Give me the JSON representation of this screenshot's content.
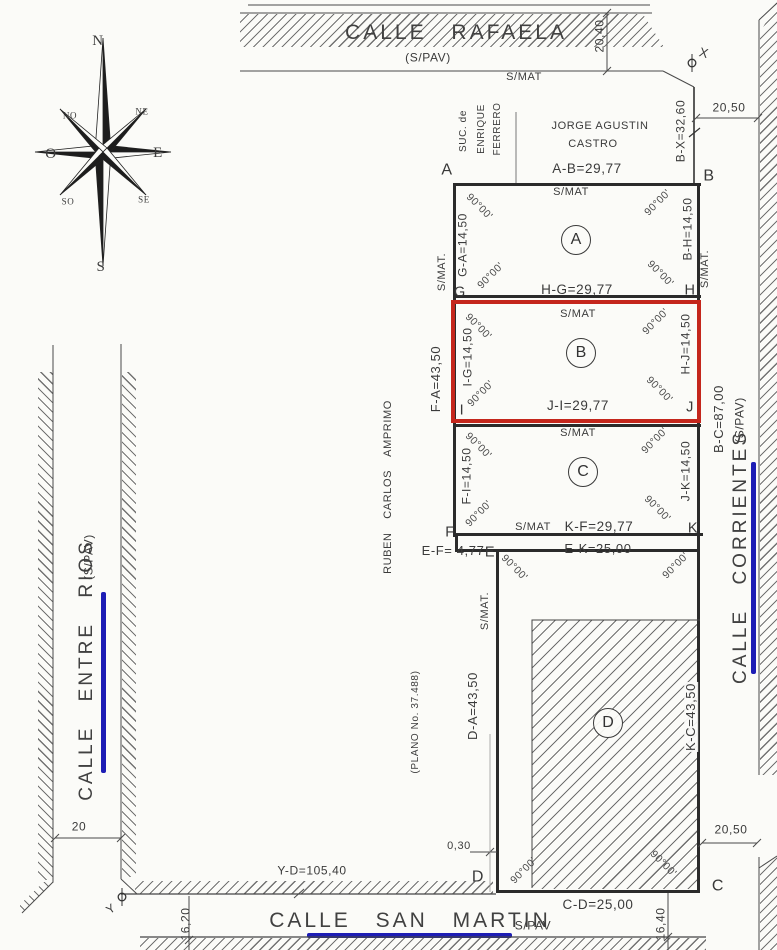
{
  "compass": {
    "n": "N",
    "s": "S",
    "e": "E",
    "o": "O",
    "ne": "NE",
    "no": "NO",
    "se": "SE",
    "so": "SO"
  },
  "streets": {
    "rafaela": {
      "name": "CALLE RAFAELA",
      "surface": "(S/PAV)"
    },
    "corrientes": {
      "name": "CALLE CORRIENTES",
      "surface": "(S/PAV)"
    },
    "entre_rios": {
      "name": "CALLE ENTRE RIOS",
      "surface": "(S/PAV)"
    },
    "san_martin": {
      "name": "CALLE SAN MARTIN",
      "surface": "S/PAV"
    }
  },
  "neighbors": {
    "ferrero_line1": "SUC. de",
    "ferrero_line2": "ENRIQUE",
    "ferrero_line3": "FERRERO",
    "castro_line1": "JORGE AGUSTIN",
    "castro_line2": "CASTRO",
    "amprimo": "RUBEN CARLOS AMPRIMO",
    "plano_ref": "(PLANO No. 37.488)"
  },
  "lots": {
    "a": {
      "label": "A",
      "top": "A-B=29,77",
      "left": "G-A=14,50",
      "right": "B-H=14,50",
      "bottom": "H-G=29,77"
    },
    "b": {
      "label": "B",
      "left": "I-G=14,50",
      "right": "H-J=14,50",
      "bottom": "J-I=29,77"
    },
    "c": {
      "label": "C",
      "left": "F-I=14,50",
      "right": "J-K=14,50",
      "bottom": "K-F=29,77"
    },
    "d": {
      "label": "D",
      "top": "E-K=25,00",
      "left": "D-A=43,50",
      "right": "K-C=43,50",
      "bottom": "C-D=25,00"
    }
  },
  "corners": {
    "a": "A",
    "b": "B",
    "c": "C",
    "d": "D",
    "e": "E",
    "f": "F",
    "g": "G",
    "h": "H",
    "i": "I",
    "j": "J",
    "k": "K",
    "x": "X",
    "y": "Y"
  },
  "dims": {
    "rafaela_width": "20,40",
    "bx": "B-X=32,60",
    "offset_ne": "20,50",
    "fa": "F-A=43,50",
    "bc": "B-C=87,00",
    "ef": "E-F= 4,77",
    "wall_offset": "0,30",
    "yd": "Y-D=105,40",
    "entre_rios_width": "20",
    "sw": "16,20",
    "se": "16,40",
    "offset_se": "20,50"
  },
  "labels": {
    "angle": "90°00'",
    "smat": "S/MAT",
    "smat_dot": "S/MAT."
  },
  "colors": {
    "highlight_lot": "#c4261c",
    "street_axis": "#1d1db5",
    "ink": "#2e2e2e"
  }
}
